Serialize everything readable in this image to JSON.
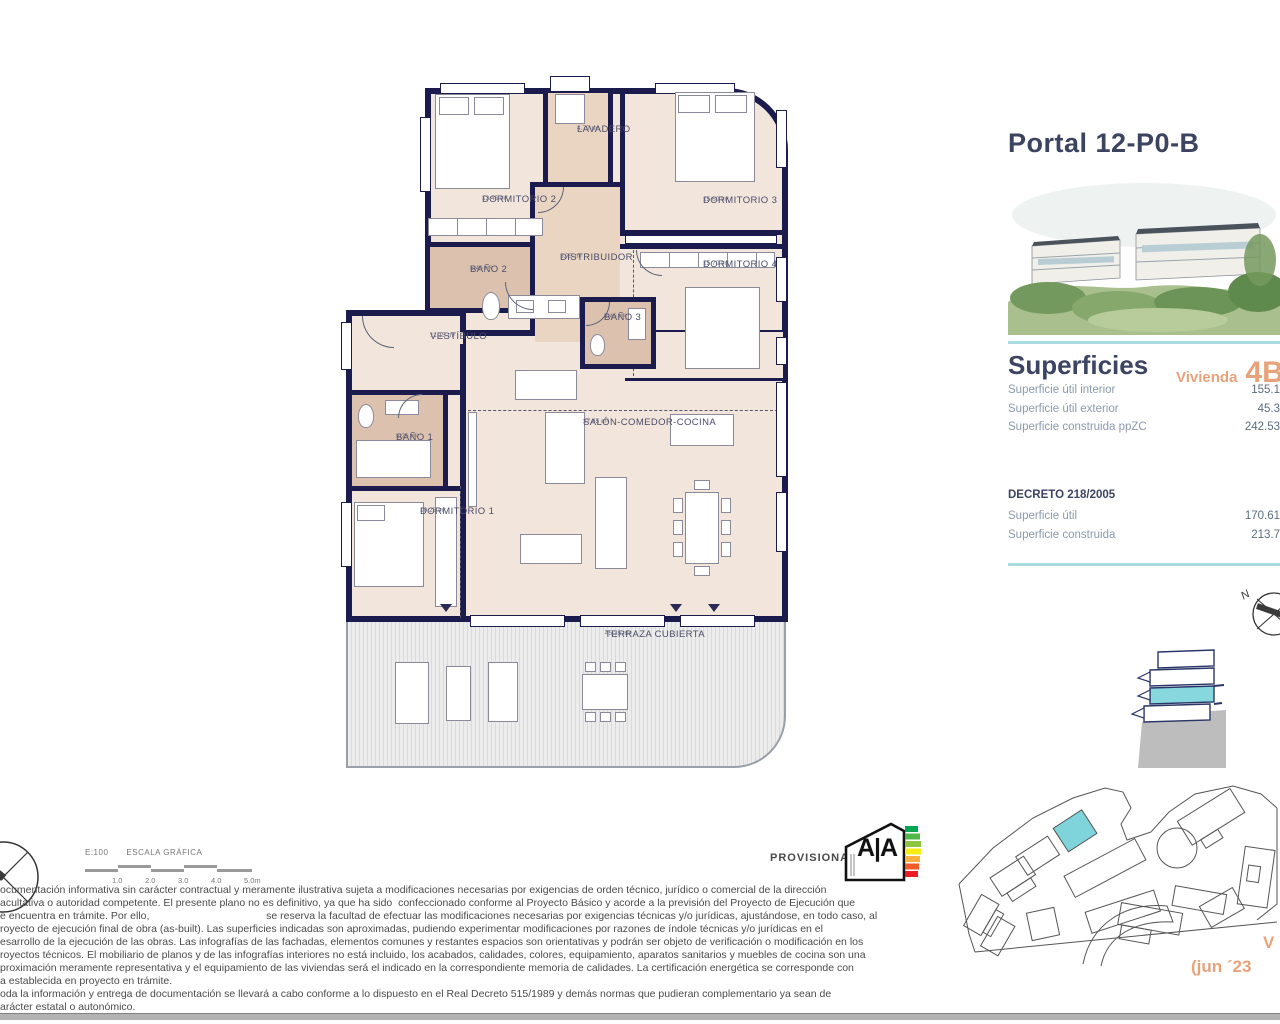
{
  "header": {
    "portal_title": "Portal 12-P0-B"
  },
  "floor_plan": {
    "rooms": [
      {
        "name": "DORMITORIO 2",
        "area": "13.45 m²"
      },
      {
        "name": "LAVADERO",
        "area": "4.70 m²"
      },
      {
        "name": "DORMITORIO 3",
        "area": "15.60 m²"
      },
      {
        "name": "DORMITORIO 4",
        "area": "15.70 m²"
      },
      {
        "name": "BAÑO 2",
        "area": "5.40 m²"
      },
      {
        "name": "DISTRIBUIDOR",
        "area": "3.75 m²"
      },
      {
        "name": "BAÑO 3",
        "area": "2.45 m²"
      },
      {
        "name": "VESTÍBULO",
        "area": "11.15 m²"
      },
      {
        "name": "BAÑO 1",
        "area": "5.75 m²"
      },
      {
        "name": "DORMITORIO 1",
        "area": "10.25 m²"
      },
      {
        "name": "SALÓN-COMEDOR-COCINA",
        "area": "37.45 m²"
      },
      {
        "name": "TERRAZA CUBIERTA",
        "area": "45.35 m²"
      }
    ]
  },
  "superficies": {
    "title": "Superficies",
    "vivienda_label": "Vivienda",
    "vivienda_code": "4B",
    "rows": [
      {
        "label": "Superficie útil interior",
        "value": "155.1"
      },
      {
        "label": "Superficie útil exterior",
        "value": "45.3"
      },
      {
        "label": "Superficie construida ppZC",
        "value": "242.53"
      }
    ],
    "decreto_title": "DECRETO 218/2005",
    "decreto_rows": [
      {
        "label": "Superficie útil",
        "value": "170.61"
      },
      {
        "label": "Superficie construida",
        "value": "213.7"
      }
    ]
  },
  "scale_bar": {
    "ratio": "E:100",
    "label": "ESCALA GRÁFICA",
    "ticks": [
      "1.0",
      "2.0",
      "3.0",
      "4.0",
      "5.0m"
    ]
  },
  "energy": {
    "provisional": "PROVISIONAL",
    "letters": "A|A"
  },
  "compass": {
    "north": "N"
  },
  "version": {
    "line1": "V",
    "line2": "(jun ´23"
  },
  "disclaimer": {
    "text": "ocumentación informativa sin carácter contractual y meramente ilustrativa sujeta a modificaciones necesarias por exigencias de orden técnico, jurídico o comercial de la dirección\nacultativa o autoridad competente. El presente plano no es definitivo, ya que ha sido  confeccionado conforme al Proyecto Básico y acorde a la previsión del Proyecto de Ejecución que\ne encuentra en trámite. Por ello,                                        se reserva la facultad de efectuar las modificaciones necesarias por exigencias técnicas y/o jurídicas, ajustándose, en todo caso, al\nroyecto de ejecución final de obra (as-built). Las superficies indicadas son aproximadas, pudiendo experimentar modificaciones por razones de índole técnicas y/o jurídicas en el\nesarrollo de la ejecución de las obras. Las infografías de las fachadas, elementos comunes y restantes espacios son orientativas y podrán ser objeto de verificación o modificación en los\nroyectos técnicos. El mobiliario de planos y de las infografías interiores no está incluido, los acabados, calidades, colores, equipamiento, aparatos sanitarios y muebles de cocina son una\nproximación meramente representativa y el equipamiento de las viviendas será el indicado en la correspondiente memoria de calidades. La certificación energética se corresponde con\na establecida en proyecto en trámite.\noda la información y entrega de documentación se llevará a cabo conforme a lo dispuesto en el Real Decreto 515/1989 y demás normas que pudieran complementario ya sean de\narácter estatal o autonómico."
  }
}
